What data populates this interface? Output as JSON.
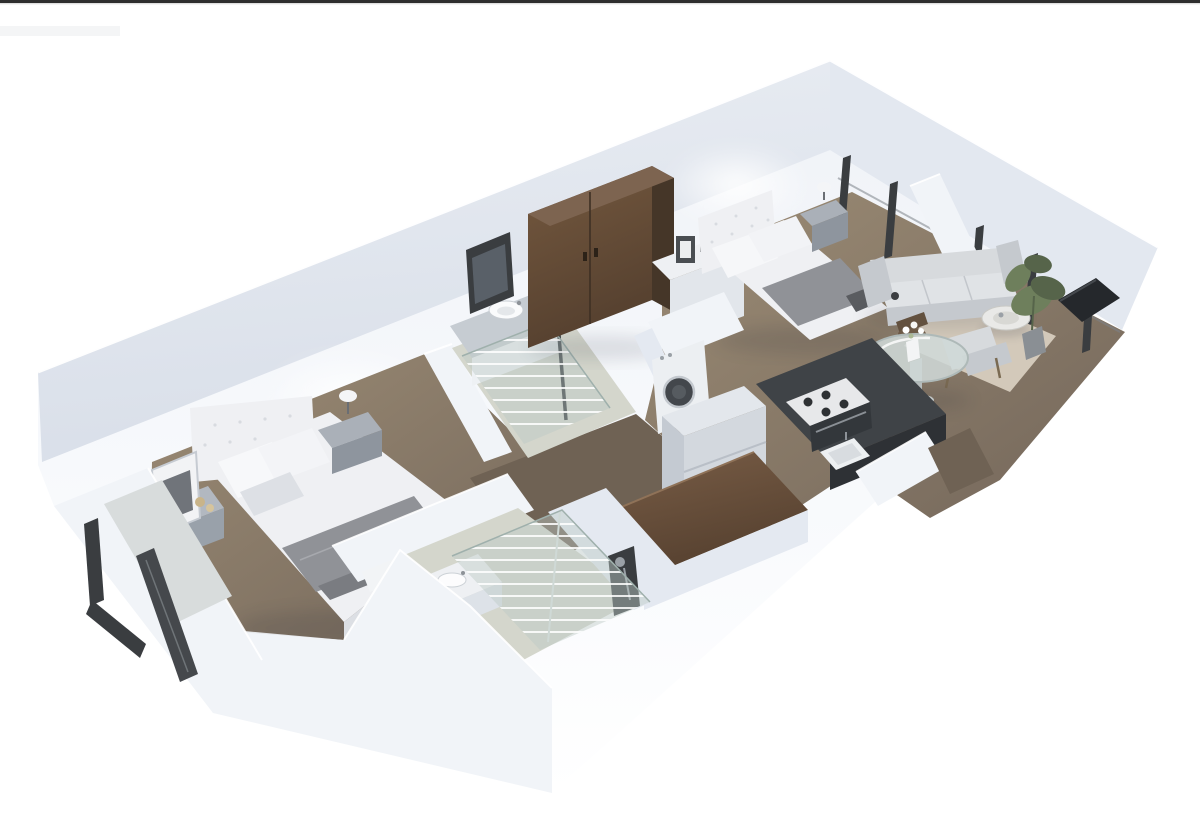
{
  "scene": {
    "kind": "3d-floor-plan-cutaway-render",
    "view": "isometric",
    "rooms": [
      {
        "name": "bedroom-1",
        "furniture": [
          "double-bed",
          "tufted-headboard",
          "pillows",
          "gray-blanket",
          "nightstand-left",
          "picture-frame",
          "nightstand-right",
          "table-lamp",
          "balcony-door"
        ]
      },
      {
        "name": "bathroom-1",
        "furniture": [
          "vanity-counter",
          "round-sink",
          "wall-mirror",
          "walk-in-shower-glass"
        ]
      },
      {
        "name": "hallway",
        "furniture": [
          "tall-wood-wardrobe"
        ]
      },
      {
        "name": "bathroom-2",
        "furniture": [
          "toilet",
          "vanity-counter",
          "round-sink",
          "walk-in-shower-glass",
          "shower-fixture"
        ]
      },
      {
        "name": "kitchen",
        "furniture": [
          "washing-machine",
          "refrigerator",
          "dark-countertop",
          "gas-stove",
          "kitchen-sink",
          "wood-island-counter"
        ]
      },
      {
        "name": "bedroom-2",
        "furniture": [
          "double-bed",
          "tufted-headboard",
          "gray-blanket",
          "white-dresser",
          "picture-frames",
          "nightstand",
          "table-lamp"
        ]
      },
      {
        "name": "dining-area",
        "furniture": [
          "round-glass-table",
          "wood-chairs",
          "flower-vase"
        ]
      },
      {
        "name": "living-room",
        "furniture": [
          "three-seat-sofa",
          "coffee-table",
          "area-rug",
          "armchair",
          "potted-plant",
          "tv-panel",
          "window-wall"
        ]
      }
    ]
  },
  "colors": {
    "background": "#ffffff",
    "top_bar": "#2e2e2e",
    "top_bar_line": "#ececec",
    "wall_face": "#e9edf3",
    "wall_face_dark": "#d9dfe9",
    "wall_side": "#e3e8f0",
    "wall_band": "#f1f4f8",
    "wall_band_shadow": "#e4e9f1",
    "floor_wood_light": "#9c8c75",
    "floor_wood_dark": "#73665a",
    "floor_hall": "#6f6254",
    "tile_light": "#d4d6cc",
    "wood_dark_hi": "#75593f",
    "wood_dark": "#55402f",
    "wood_dark_side": "#453628",
    "wood_dark_top": "#7d6450",
    "island_wood": "#7a5e47",
    "counter_dark": "#3f4347",
    "counter_darker": "#2e3135",
    "fabric_white": "#eff0f3",
    "fabric_light": "#dde0e5",
    "fabric_gray": "#909297",
    "fabric_dark": "#7a7c81",
    "sofa": "#d7dadd",
    "sofa_shadow": "#c5c9ce",
    "glass": "#bcc9c6",
    "frame_dark": "#3a3d40",
    "metal": "#9aa0a6",
    "plant_green": "#6e7f5c",
    "plant_dark": "#56644a",
    "rug": "#d3c9ba",
    "washer_door": "#43474c",
    "slab": "#d8dcdc"
  }
}
